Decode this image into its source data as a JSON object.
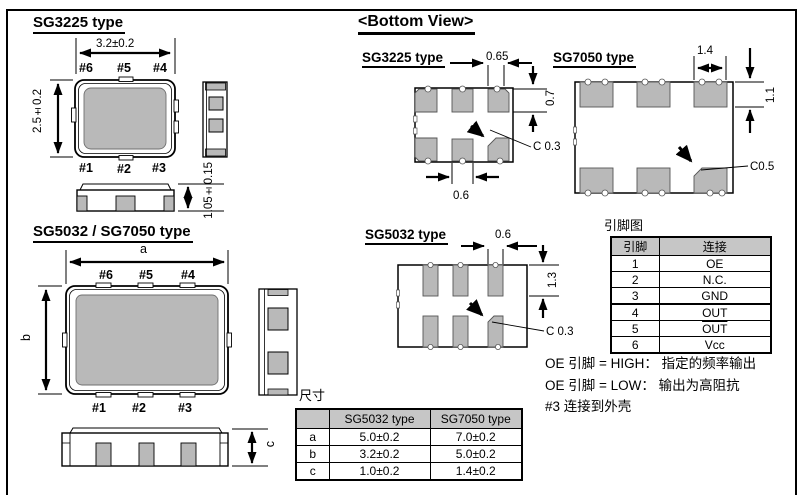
{
  "colors": {
    "line": "#000000",
    "lid_gray": "#b9b9b9",
    "pad_gray": "#b9b9b9",
    "table_header_gray": "#c6c6c6",
    "background": "#ffffff"
  },
  "sg3225": {
    "title": "SG3225 type",
    "dim_width": "3.2±0.2",
    "dim_height": "2.5±0.2",
    "dim_thickness": "1.05±0.15",
    "pins_top": [
      "#6",
      "#5",
      "#4"
    ],
    "pins_bottom": [
      "#1",
      "#2",
      "#3"
    ]
  },
  "sg5032_7050": {
    "title": "SG5032 / SG7050 type",
    "dim_width": "a",
    "dim_height": "b",
    "dim_thickness": "c",
    "pins_top": [
      "#6",
      "#5",
      "#4"
    ],
    "pins_bottom": [
      "#1",
      "#2",
      "#3"
    ]
  },
  "bottom_view": {
    "title": "<Bottom View>",
    "sg3225": {
      "title": "SG3225 type",
      "pad_width": "0.65",
      "pad_height": "0.7",
      "pad_width_bottom": "0.6",
      "chamfer": "C 0.3"
    },
    "sg7050": {
      "title": "SG7050 type",
      "pad_width": "1.4",
      "pad_height": "1.1",
      "chamfer": "C0.5"
    },
    "sg5032": {
      "title": "SG5032 type",
      "pad_width": "0.6",
      "pad_height": "1.3",
      "chamfer": "C 0.3"
    }
  },
  "pin_map": {
    "title": "引脚图",
    "headers": [
      "引脚",
      "连接"
    ],
    "rows": [
      [
        "1",
        "OE"
      ],
      [
        "2",
        "N.C."
      ],
      [
        "3",
        "GND"
      ],
      [
        "4",
        "OUT"
      ],
      [
        "5",
        "OUT"
      ],
      [
        "6",
        "Vcc"
      ]
    ]
  },
  "notes": {
    "line1": "OE 引脚 = HIGH： 指定的频率输出",
    "line2": "OE 引脚 = LOW： 输出为高阻抗",
    "line3": "#3 连接到外壳"
  },
  "dimensions_table": {
    "title": "尺寸",
    "headers": [
      "",
      "SG5032 type",
      "SG7050 type"
    ],
    "rows": [
      [
        "a",
        "5.0±0.2",
        "7.0±0.2"
      ],
      [
        "b",
        "3.2±0.2",
        "5.0±0.2"
      ],
      [
        "c",
        "1.0±0.2",
        "1.4±0.2"
      ]
    ]
  }
}
